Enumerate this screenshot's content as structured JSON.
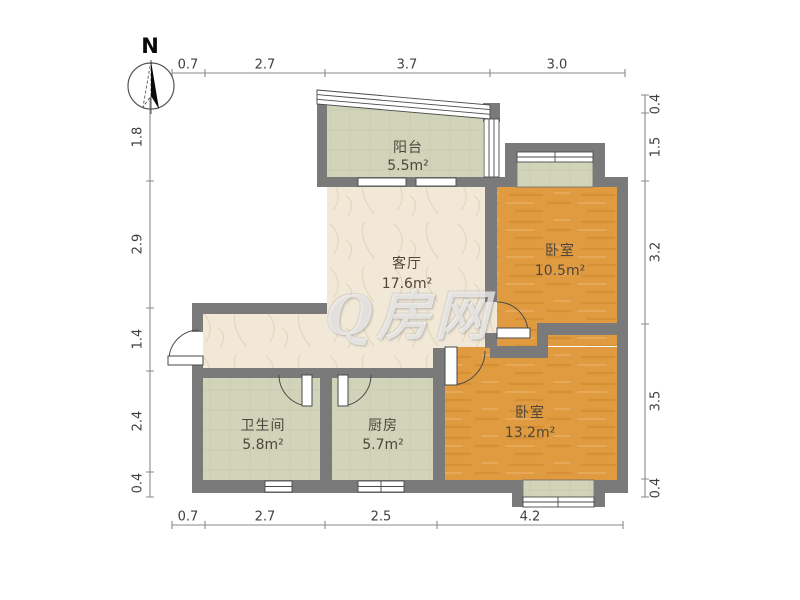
{
  "compass": {
    "label": "N"
  },
  "watermark": {
    "text": "Q房网"
  },
  "rooms": {
    "balcony": {
      "name": "阳台",
      "area": "5.5m²"
    },
    "living": {
      "name": "客厅",
      "area": "17.6m²"
    },
    "bedroom1": {
      "name": "卧室",
      "area": "10.5m²"
    },
    "bedroom2": {
      "name": "卧室",
      "area": "13.2m²"
    },
    "bathroom": {
      "name": "卫生间",
      "area": "5.8m²"
    },
    "kitchen": {
      "name": "厨房",
      "area": "5.7m²"
    }
  },
  "dimensions": {
    "top": [
      "0.7",
      "2.7",
      "3.7",
      "3.0"
    ],
    "bottom": [
      "0.7",
      "2.7",
      "2.5",
      "4.2"
    ],
    "left": [
      "1.8",
      "2.9",
      "1.4",
      "2.4",
      "0.4"
    ],
    "right": [
      "0.4",
      "1.5",
      "3.2",
      "3.5",
      "0.4"
    ]
  },
  "colors": {
    "wall": "#7a7a7a",
    "living_floor": "#f1e8d7",
    "bedroom_floor": "#e09a40",
    "tile_floor": "#d2d4ba",
    "window": "#ffffff",
    "dim_line": "#8a8a8a"
  }
}
